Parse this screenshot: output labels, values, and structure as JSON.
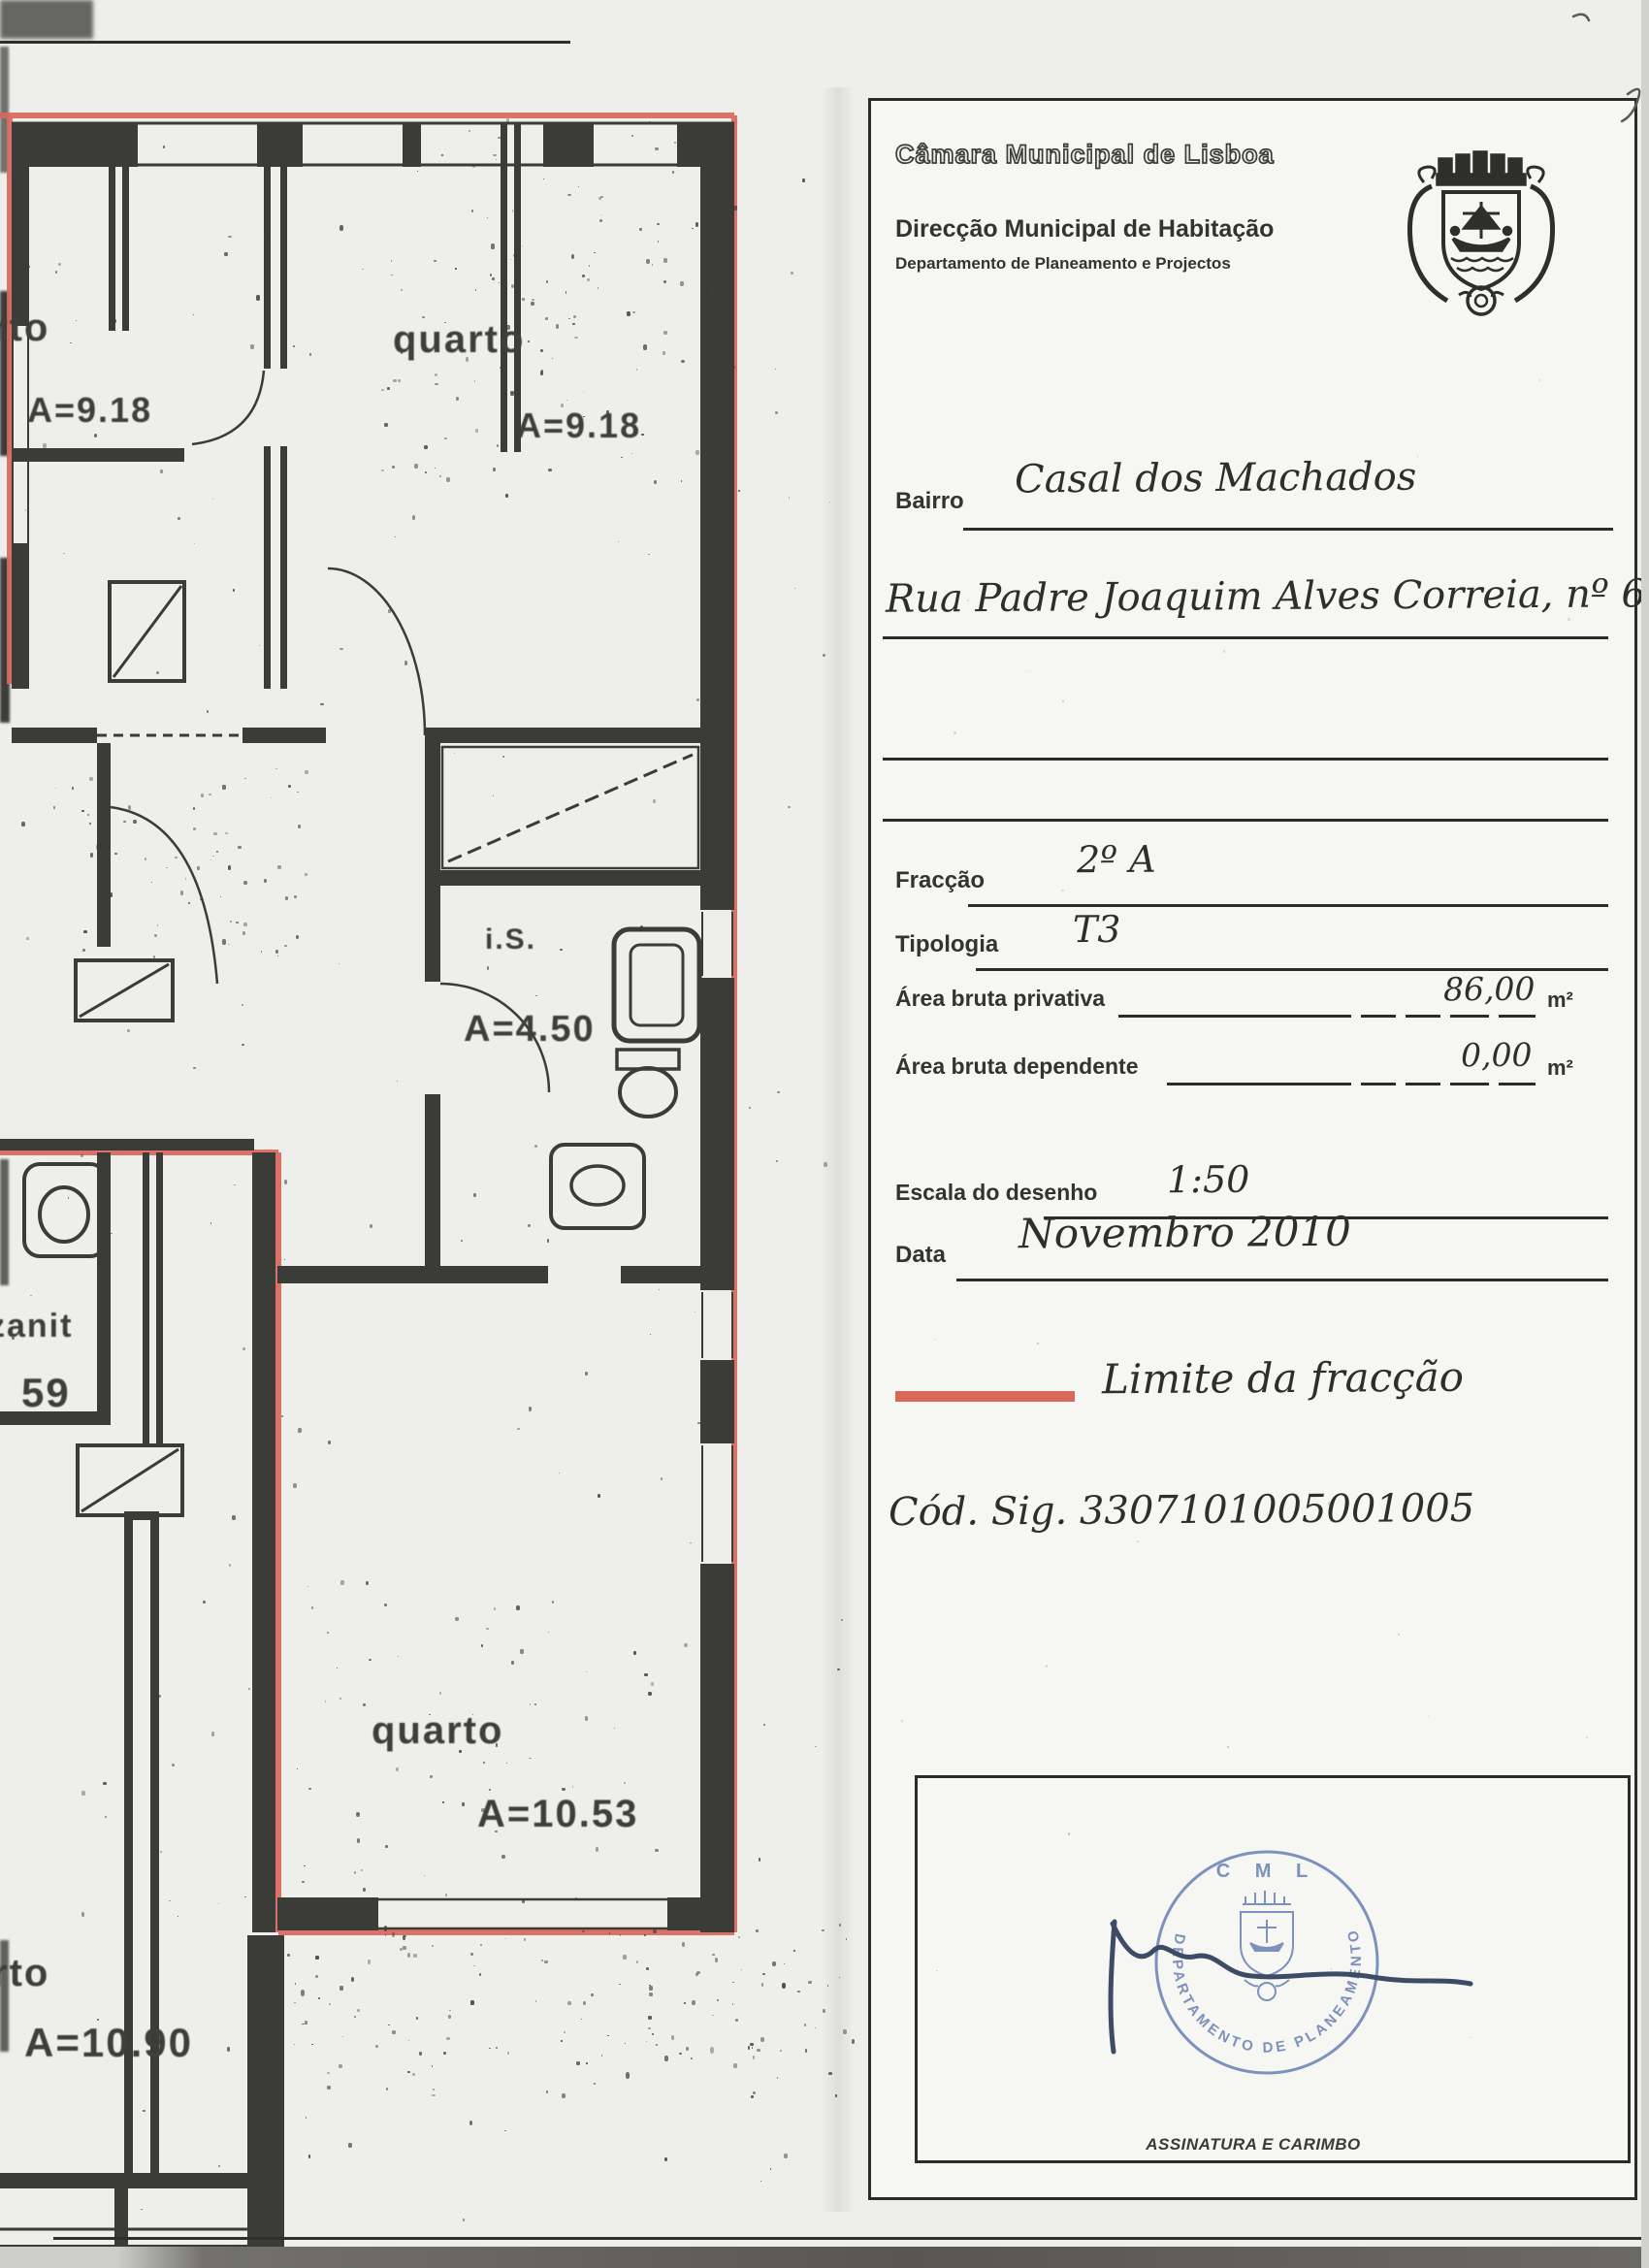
{
  "header": {
    "org": "Câmara Municipal de Lisboa",
    "division": "Direcção Municipal de Habitação",
    "department": "Departamento de Planeamento e Projectos"
  },
  "form": {
    "bairro_label": "Bairro",
    "bairro_value": "Casal dos Machados",
    "address_value": "Rua Padre Joaquim Alves Correia, nº 6",
    "fraccao_label": "Fracção",
    "fraccao_value": "2º A",
    "tipologia_label": "Tipologia",
    "tipologia_value": "T3",
    "area_privativa_label": "Área bruta privativa",
    "area_privativa_value": "86,00",
    "area_dependente_label": "Área bruta dependente",
    "area_dependente_value": "0,00",
    "area_unit": "m²",
    "escala_label": "Escala do desenho",
    "escala_value": "1:50",
    "data_label": "Data",
    "data_value": "Novembro 2010",
    "legend_label": "Limite da fracção",
    "cod_sig": "Cód. Sig. 3307101005001005",
    "assinatura_label": "ASSINATURA E CARIMBO"
  },
  "stamp": {
    "cml": "C M L",
    "ring": "DEPARTAMENTO DE PLANEAMENTO E PROJECTOS"
  },
  "plan": {
    "room1_label": "rto",
    "room1_area": "A=9.18",
    "room2_label": "quarto",
    "room2_area": "A=9.18",
    "is_label": "i.S.",
    "is_area": "A=4.50",
    "partial_label": "zanit",
    "partial_area": "59",
    "room3_label": "quarto",
    "room3_area": "A=10.53",
    "room4_label": "rto",
    "room4_area": "A=10.90"
  },
  "colors": {
    "fraction_boundary": "#d9675c",
    "stamp_blue": "#6780b4",
    "ink": "#3b3b37"
  }
}
